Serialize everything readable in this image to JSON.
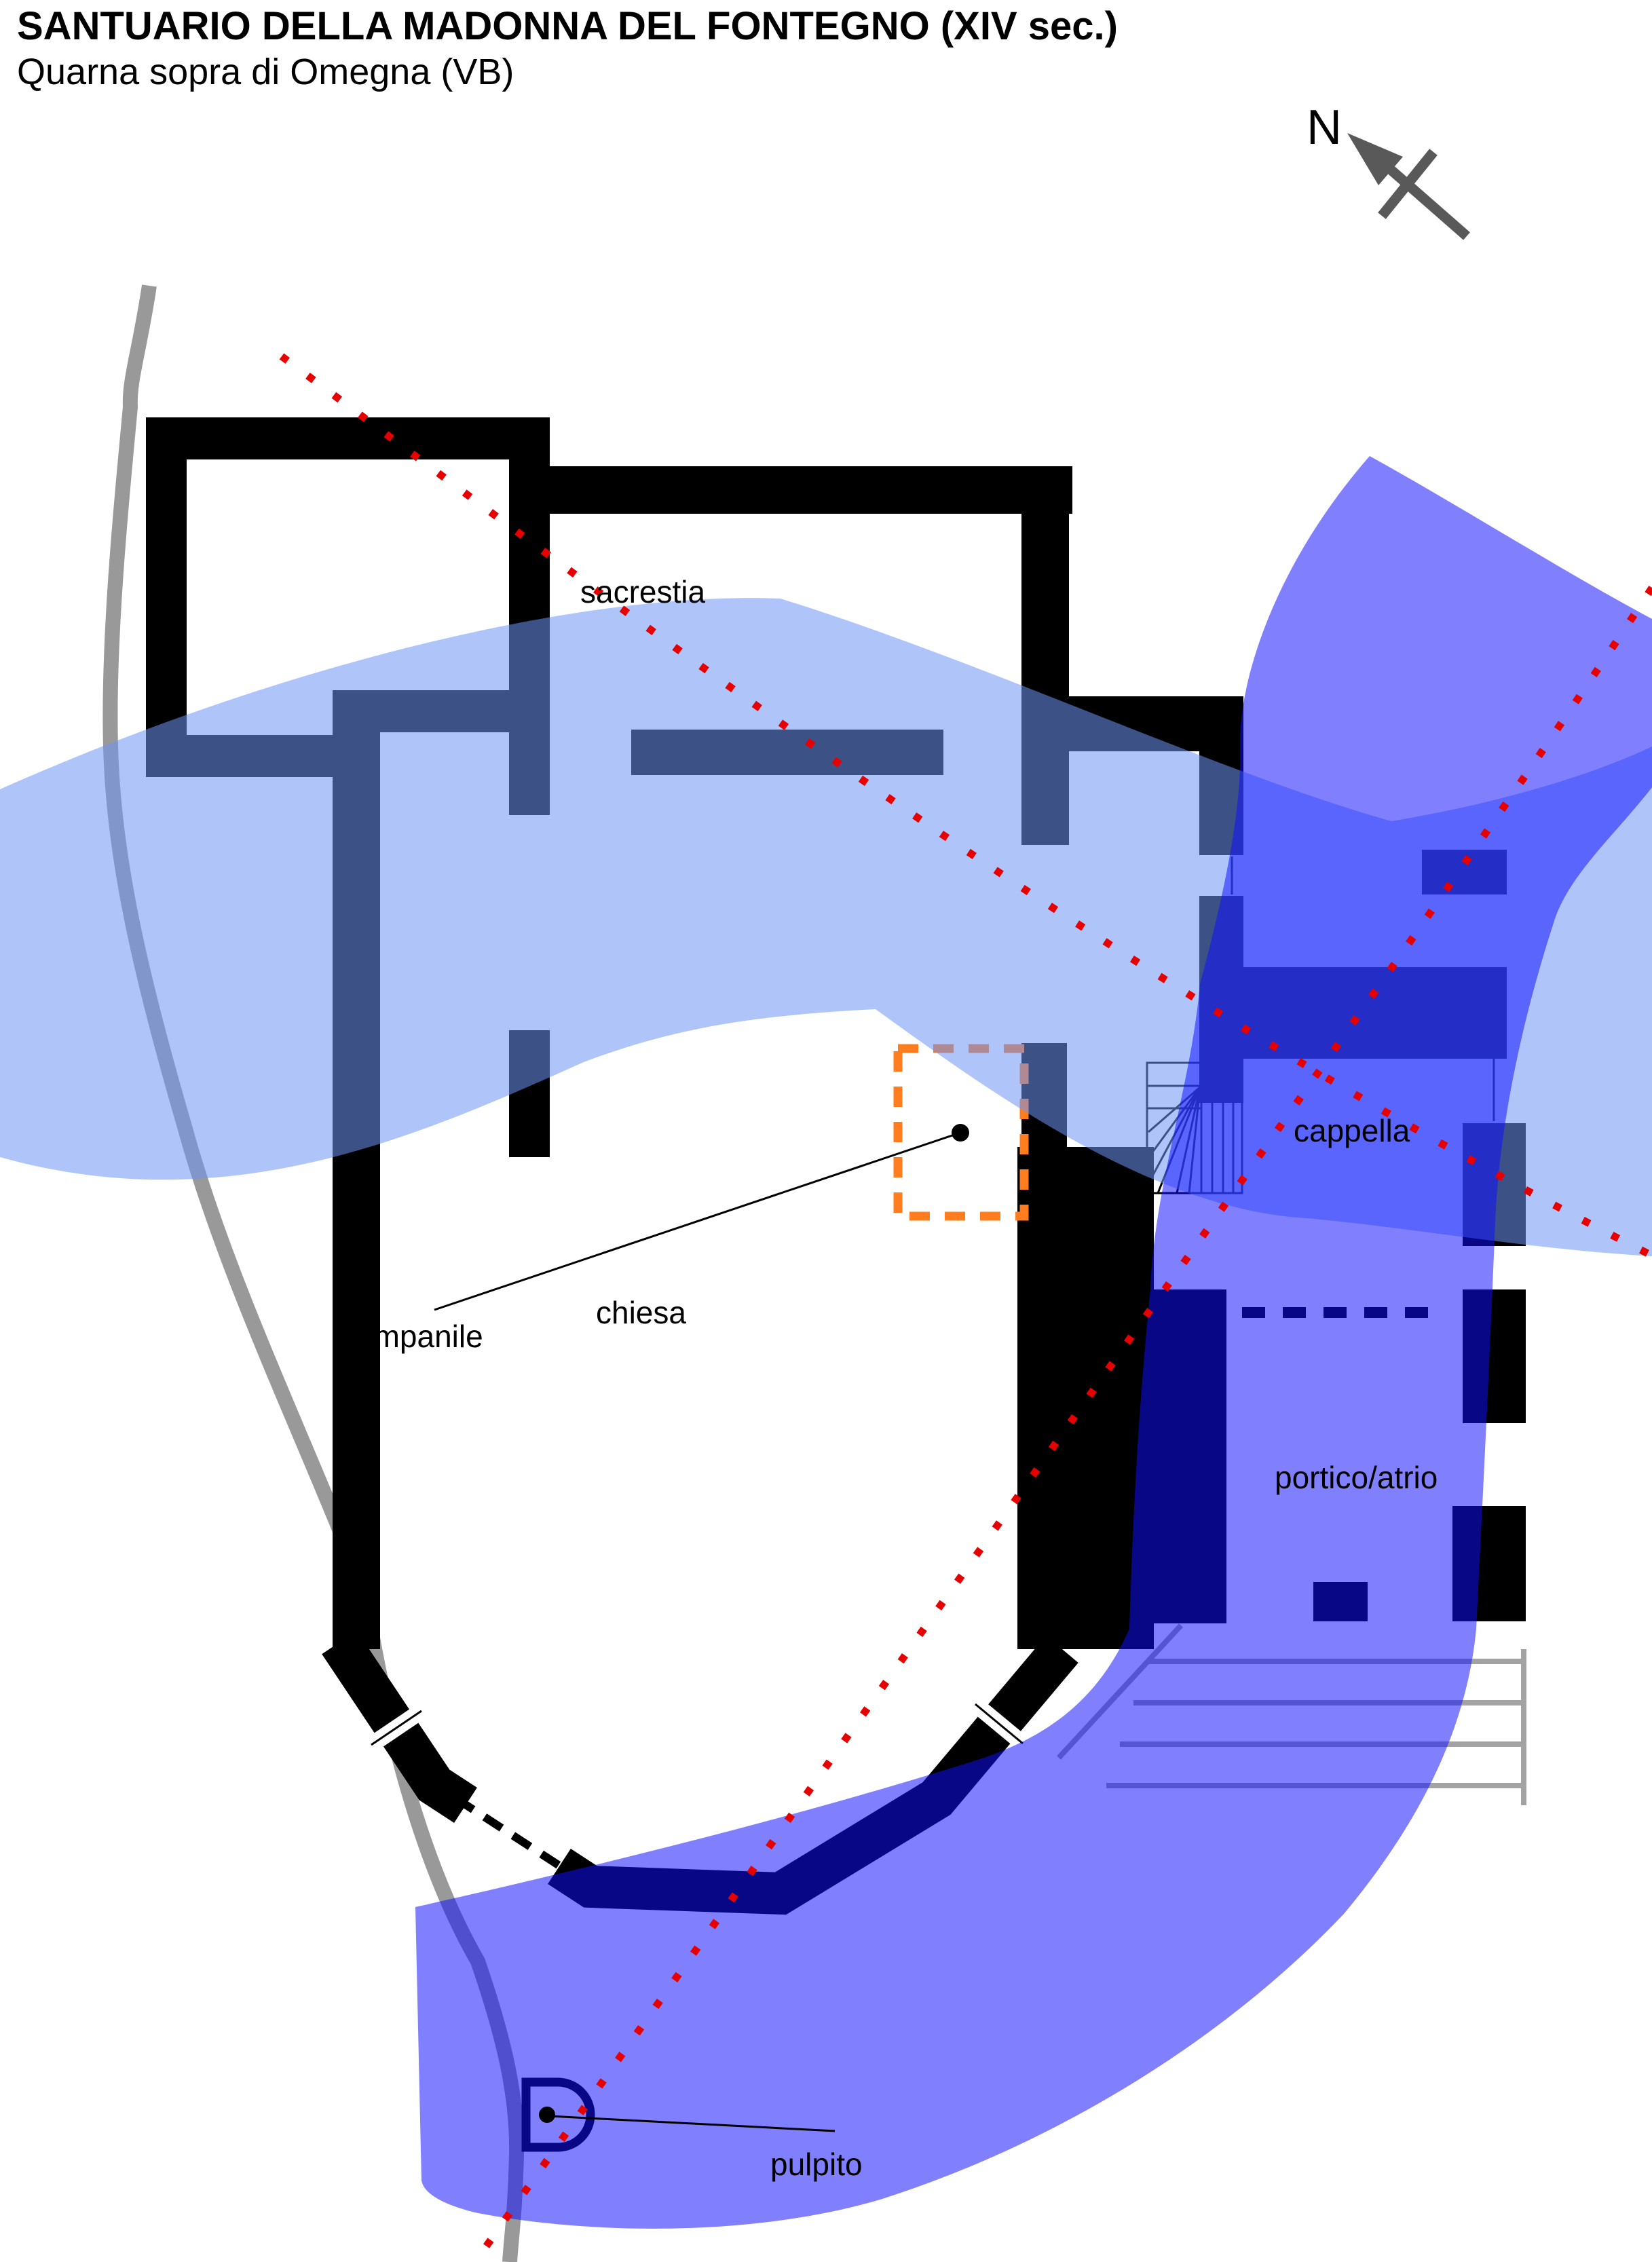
{
  "title": "SANTUARIO DELLA MADONNA DEL FONTEGNO (XIV sec.)",
  "subtitle": "Quarna sopra di Omegna (VB)",
  "compass": {
    "label": "N"
  },
  "labels": {
    "sacrestia": "sacrestia",
    "cappella": "cappella",
    "campanile": "campanile",
    "chiesa": "chiesa",
    "portico_atrio": "portico/atrio",
    "pulpito": "pulpito"
  },
  "colors": {
    "paper": "#ffffff",
    "ink": "#000000",
    "wall": "#000000",
    "stream": "#999999",
    "steps": "#a3a3a3",
    "overlay_light_blue": "#6e96f6",
    "overlay_purple": "#0f0fff",
    "section_line": "#e60000",
    "campanile_marker": "#ff7d1e",
    "compass": "#595959"
  }
}
